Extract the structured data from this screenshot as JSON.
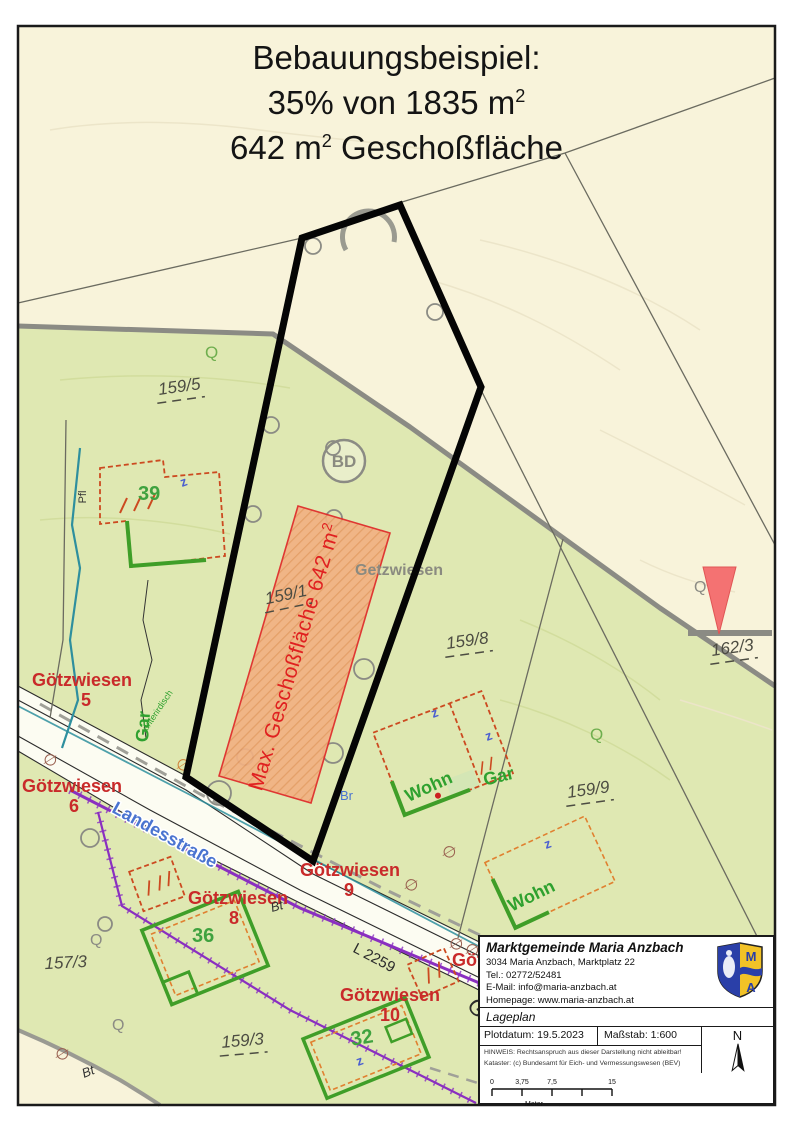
{
  "title": {
    "line1": "Bebauungsbeispiel:",
    "line2_main": "35% von 1835 m",
    "line2_sup": "2",
    "line3_main": "642 m",
    "line3_sup": "2",
    "line3_rest": " Geschoßfläche"
  },
  "map": {
    "plot_area_label": "Max. Geschoßfläche 642 m",
    "plot_area_sup": "2",
    "parcel_159_5": "159/5",
    "parcel_159_1": "159/1",
    "parcel_159_8": "159/8",
    "parcel_159_9": "159/9",
    "parcel_162_3": "162/3",
    "parcel_157_3": "157/3",
    "parcel_159_3": "159/3",
    "street_landesstrasse": "Landesstraße",
    "street_l2259": "L 2259",
    "street_goetzwiesen_rot": "Götzwiesen",
    "addr5_name": "Götzwiesen",
    "addr5_num": "5",
    "addr6_name": "Götzwiesen",
    "addr6_num": "6",
    "addr8_name": "Götzwiesen",
    "addr8_num": "8",
    "addr9_name": "Götzwiesen",
    "addr9_num": "9",
    "addr10_name": "Götzwiesen",
    "addr10_num": "10",
    "addr_partial": "Götzwiesen",
    "house_39": "39",
    "house_36": "36",
    "house_32": "32",
    "lbl_wohn": "Wohn",
    "lbl_gar": "Gar",
    "lbl_unterirdisch": "unterirdisch",
    "lbl_getzwiesen": "Getzwiesen",
    "lbl_bd": "BD",
    "lbl_br": "Br",
    "lbl_bt": "Bt",
    "lbl_pfl": "Pfl",
    "lbl_q": "Q",
    "sym_slash_circle": "∅"
  },
  "infobox": {
    "org": "Marktgemeinde Maria Anzbach",
    "address": "3034 Maria Anzbach, Marktplatz 22",
    "tel": "Tel.: 02772/52481",
    "email": "E-Mail: info@maria-anzbach.at",
    "homepage": "Homepage: www.maria-anzbach.at",
    "doc_type": "Lageplan",
    "plotdate": "Plotdatum: 19.5.2023",
    "scale": "Maßstab: 1:600",
    "note1": "HINWEIS: Rechtsanspruch aus dieser Darstellung nicht ableitbar!",
    "note2": "Kataster: (c) Bundesamt für Eich- und Vermessungswesen (BEV)",
    "north_label": "N",
    "logo_m": "M",
    "logo_a": "A",
    "scalebar": {
      "t0": "0",
      "t1": "3,75",
      "t2": "7,5",
      "t3": "15",
      "unit": "Meter"
    }
  },
  "colors": {
    "cream": "#f8f3da",
    "green": "#dfe8b2",
    "plot_outline": "#000000",
    "hatch_fill": "#f2b183",
    "hatch_stroke": "#e02828",
    "red_label": "#e02020",
    "street_red": "#c92a2a",
    "street_blue": "#4a74d0",
    "green_label": "#3fa23f",
    "purple": "#8a2fc0",
    "teal": "#2e8f9e",
    "gray_boundary": "#8b8b84",
    "marker_red": "#f47272"
  }
}
